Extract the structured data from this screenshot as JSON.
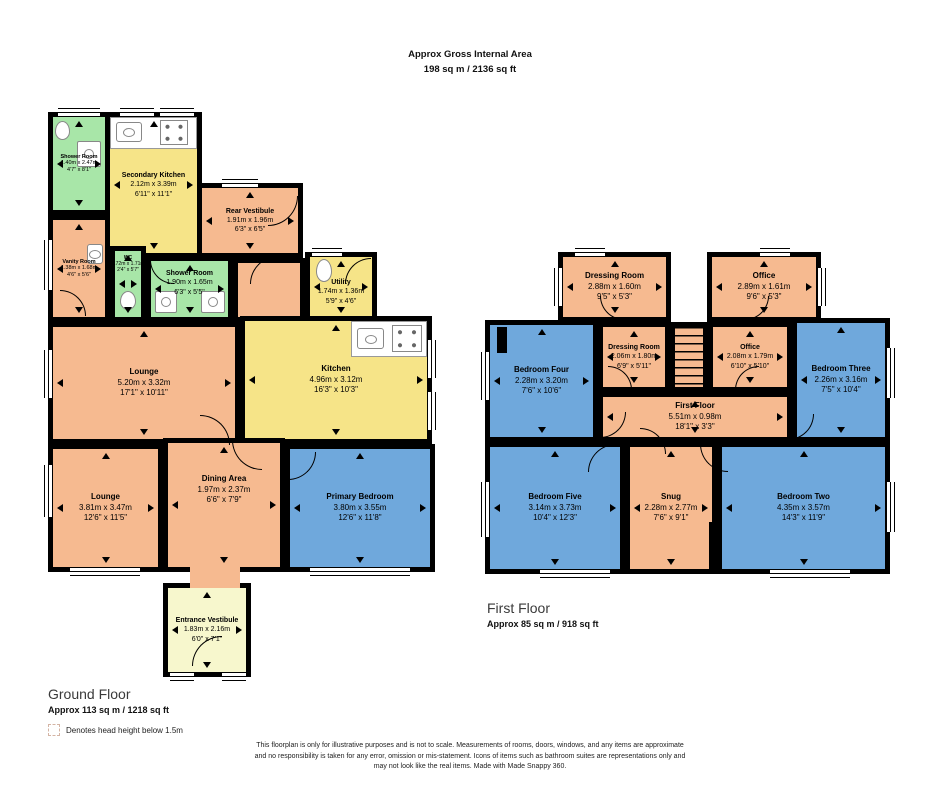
{
  "header": {
    "title": "Approx Gross Internal Area",
    "area": "198 sq m / 2136 sq ft"
  },
  "ground": {
    "label": "Ground Floor",
    "area": "Approx 113 sq m / 1218 sq ft",
    "rooms": {
      "shower1": {
        "name": "Shower Room",
        "metric": "1.40m x 2.47m",
        "imperial": "4'7\" x 8'1\""
      },
      "secondary_kitchen": {
        "name": "Secondary Kitchen",
        "metric": "2.12m x 3.39m",
        "imperial": "6'11\" x 11'1\""
      },
      "rear_vestibule": {
        "name": "Rear Vestibule",
        "metric": "1.91m x 1.96m",
        "imperial": "6'3\" x 6'5\""
      },
      "vanity": {
        "name": "Vanity Room",
        "metric": "1.38m x 1.68m",
        "imperial": "4'6\" x 5'6\""
      },
      "wc": {
        "name": "WC",
        "metric": "0.72m x 1.71m",
        "imperial": "2'4\" x 5'7\""
      },
      "shower2": {
        "name": "Shower Room",
        "metric": "1.90m x 1.65m",
        "imperial": "6'3\" x 5'5\""
      },
      "utility": {
        "name": "Utility",
        "metric": "1.74m x 1.36m",
        "imperial": "5'9\" x 4'6\""
      },
      "lounge1": {
        "name": "Lounge",
        "metric": "5.20m x 3.32m",
        "imperial": "17'1\" x 10'11\""
      },
      "kitchen": {
        "name": "Kitchen",
        "metric": "4.96m x 3.12m",
        "imperial": "16'3\" x 10'3\""
      },
      "lounge2": {
        "name": "Lounge",
        "metric": "3.81m x 3.47m",
        "imperial": "12'6\" x 11'5\""
      },
      "dining": {
        "name": "Dining Area",
        "metric": "1.97m x 2.37m",
        "imperial": "6'6\" x 7'9\""
      },
      "primary": {
        "name": "Primary Bedroom",
        "metric": "3.80m x 3.55m",
        "imperial": "12'6\" x 11'8\""
      },
      "entrance": {
        "name": "Entrance Vestibule",
        "metric": "1.83m x 2.16m",
        "imperial": "6'0\" x 7'1\""
      }
    }
  },
  "first": {
    "label": "First Floor",
    "area": "Approx 85 sq m / 918 sq ft",
    "rooms": {
      "dressing1": {
        "name": "Dressing Room",
        "metric": "2.88m x 1.60m",
        "imperial": "9'5\" x 5'3\""
      },
      "office1": {
        "name": "Office",
        "metric": "2.89m x 1.61m",
        "imperial": "9'6\" x 5'3\""
      },
      "bedroom4": {
        "name": "Bedroom Four",
        "metric": "2.28m x 3.20m",
        "imperial": "7'6\" x 10'6\""
      },
      "dressing2": {
        "name": "Dressing Room",
        "metric": "2.06m x 1.80m",
        "imperial": "6'9\" x 5'11\""
      },
      "office2": {
        "name": "Office",
        "metric": "2.08m x 1.79m",
        "imperial": "6'10\" x 5'10\""
      },
      "bedroom3": {
        "name": "Bedroom Three",
        "metric": "2.26m x 3.16m",
        "imperial": "7'5\" x 10'4\""
      },
      "landing": {
        "name": "First Floor",
        "metric": "5.51m x 0.98m",
        "imperial": "18'1\" x 3'3\""
      },
      "bedroom5": {
        "name": "Bedroom Five",
        "metric": "3.14m x 3.73m",
        "imperial": "10'4\" x 12'3\""
      },
      "snug": {
        "name": "Snug",
        "metric": "2.28m x 2.77m",
        "imperial": "7'6\" x 9'1\""
      },
      "bedroom2": {
        "name": "Bedroom Two",
        "metric": "4.35m x 3.57m",
        "imperial": "14'3\" x 11'9\""
      }
    }
  },
  "legend": {
    "text": "Denotes head height below 1.5m"
  },
  "disclaimer": {
    "line1": "This floorplan is only for illustrative purposes and is not to scale. Measurements of rooms, doors, windows, and any items are approximate",
    "line2": "and no responsibility is taken for any error, omission or mis-statement. Icons of items such as bathroom suites are representations only and",
    "line3": "may not look like the real items. Made with Made Snappy 360."
  },
  "colors": {
    "walls": "#000000",
    "room_salmon": "#F6BA90",
    "room_blue": "#6FA8DC",
    "room_yellow": "#F6E488",
    "room_green": "#A8E6A8",
    "room_cream": "#F7F7CD"
  }
}
